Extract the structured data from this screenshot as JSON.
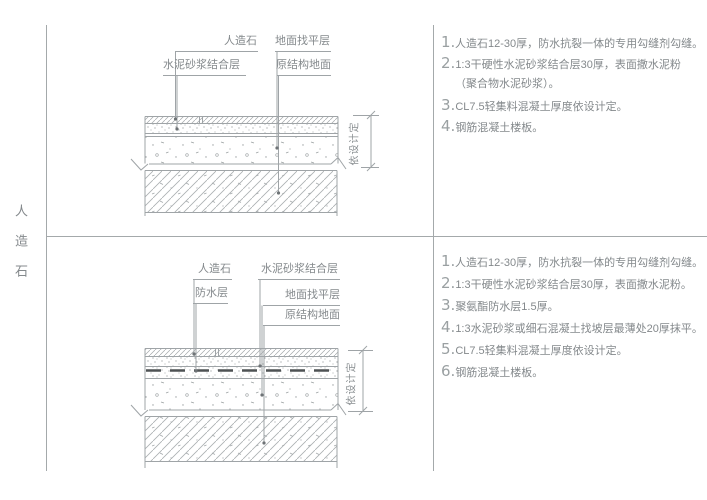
{
  "side_title": "人造石",
  "colors": {
    "line": "#a4a9ab",
    "text": "#84898c",
    "number": "#9aa0a2",
    "leader_dot": "#6e7376",
    "waterproof_line": "#4e5254",
    "background": "#ffffff"
  },
  "top_detail": {
    "labels": {
      "artificial_stone": "人造石",
      "cement_mortar_bonding": "水泥砂浆结合层",
      "floor_leveling": "地面找平层",
      "original_structure": "原结构地面"
    },
    "dim_label": "依设计定",
    "notes": [
      {
        "num": "1.",
        "text": "人造石12-30厚，防水抗裂一体的专用勾缝剂勾缝。"
      },
      {
        "num": "2.",
        "text": "1:3干硬性水泥砂浆结合层30厚，表面撒水泥粉"
      },
      {
        "num": "",
        "text": "（聚合物水泥砂浆）。"
      },
      {
        "num": "3.",
        "text": "CL7.5轻集料混凝土厚度依设计定。"
      },
      {
        "num": "4.",
        "text": "钢筋混凝土楼板。"
      }
    ]
  },
  "bottom_detail": {
    "labels": {
      "artificial_stone": "人造石",
      "waterproof_layer": "防水层",
      "cement_mortar_bonding": "水泥砂浆结合层",
      "floor_leveling": "地面找平层",
      "original_structure": "原结构地面"
    },
    "dim_label": "依设计定",
    "notes": [
      {
        "num": "1.",
        "text": "人造石12-30厚，防水抗裂一体的专用勾缝剂勾缝。"
      },
      {
        "num": "2.",
        "text": "1:3干硬性水泥砂浆结合层30厚，表面撒水泥粉。"
      },
      {
        "num": "3.",
        "text": "聚氨酯防水层1.5厚。"
      },
      {
        "num": "4.",
        "text": "1:3水泥砂浆或细石混凝土找坡层最薄处20厚抹平。"
      },
      {
        "num": "5.",
        "text": "CL7.5轻集料混凝土厚度依设计定。"
      },
      {
        "num": "6.",
        "text": "钢筋混凝土楼板。"
      }
    ]
  }
}
